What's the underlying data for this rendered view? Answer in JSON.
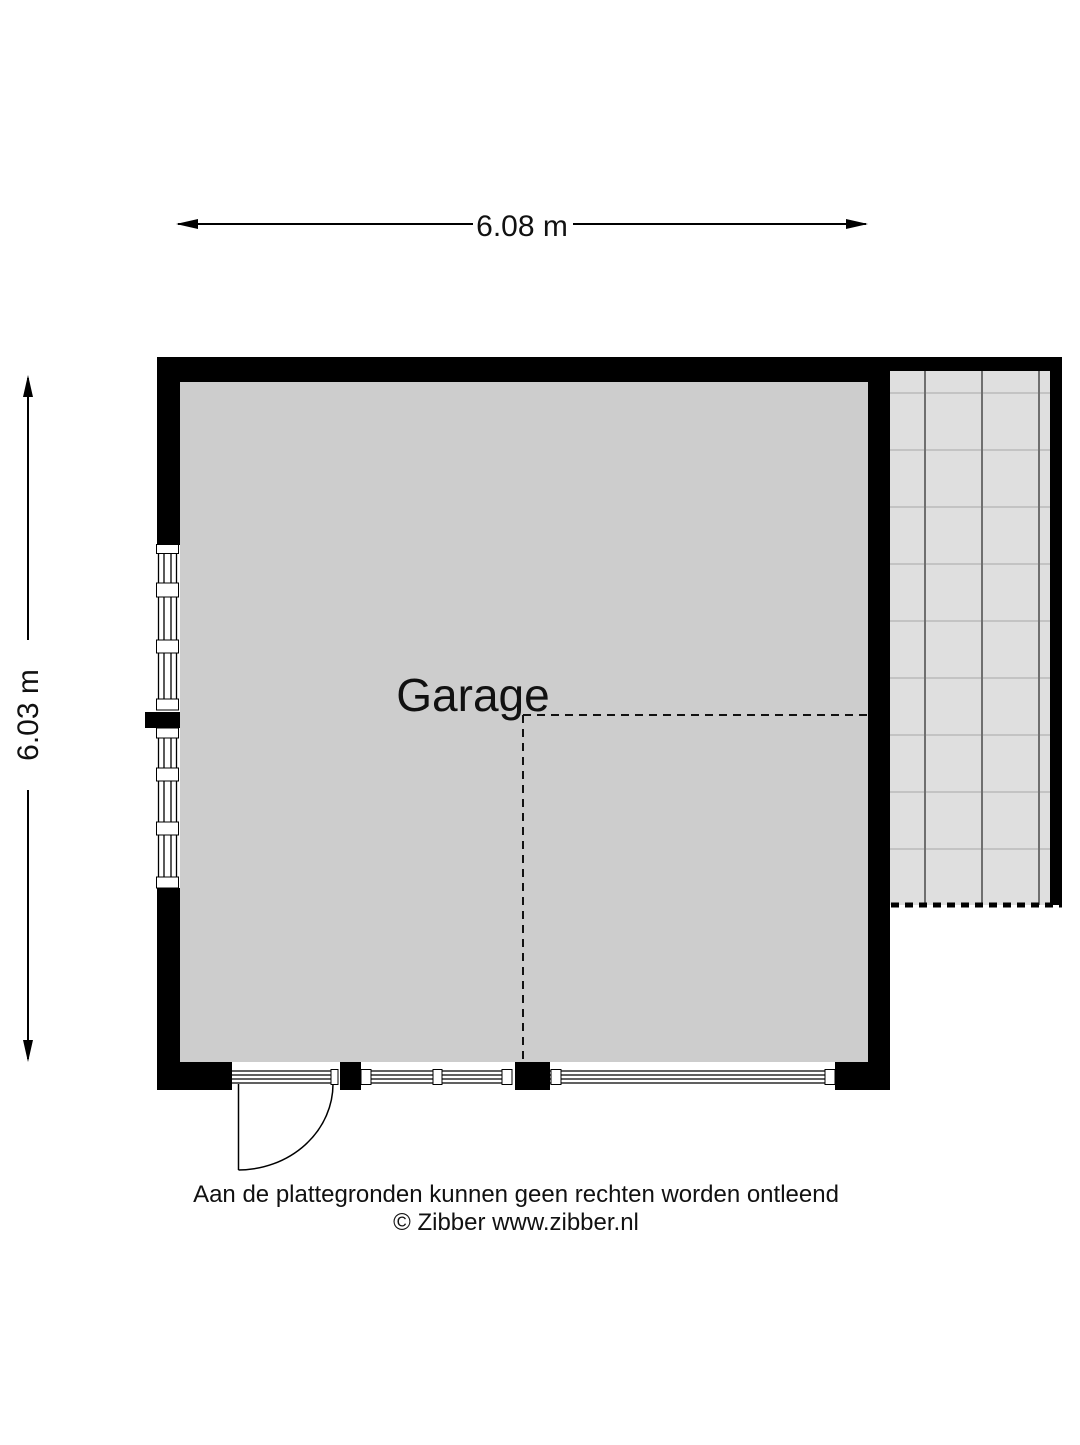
{
  "floor_plan": {
    "room": {
      "label": "Garage",
      "floor_fill": "#cdcdcd"
    },
    "canopy": {
      "fill": "#dfdfdf",
      "vertical_line_color": "#6f6f6f",
      "horizontal_line_color": "#c3c3c3",
      "grid_columns": 3,
      "grid_rows": 9
    },
    "walls": {
      "color": "#000000"
    },
    "dimensions": {
      "width": {
        "label": "6.08 m"
      },
      "height": {
        "label": "6.03 m"
      }
    },
    "footer": {
      "disclaimer": "Aan de plattegronden kunnen geen rechten worden ontleend",
      "copyright": "© Zibber www.zibber.nl"
    }
  }
}
